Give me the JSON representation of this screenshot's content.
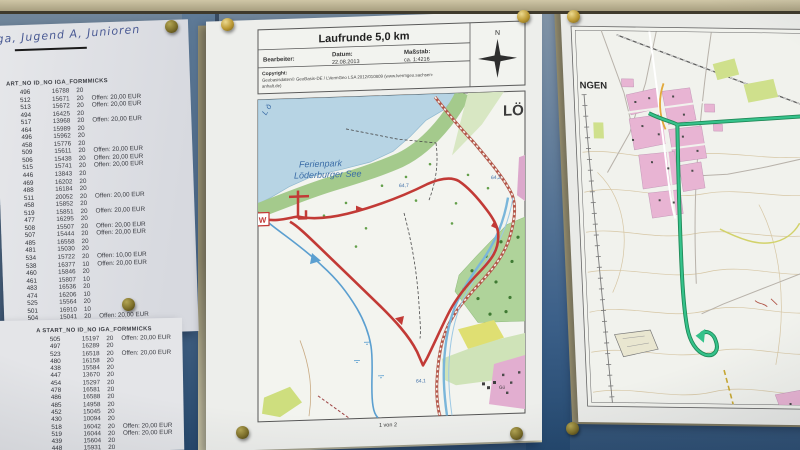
{
  "handwriting": {
    "text": "ga, Jugend A, Junioren"
  },
  "left_tables": {
    "top": {
      "header": "ART_NO  ID_NO  IGA_FORMMICKS",
      "rows": [
        [
          "496",
          "16788",
          "20",
          ""
        ],
        [
          "512",
          "15671",
          "20",
          "Offen: 20,00 EUR"
        ],
        [
          "513",
          "15672",
          "20",
          "Offen: 20,00 EUR"
        ],
        [
          "494",
          "16425",
          "20",
          ""
        ],
        [
          "517",
          "13968",
          "20",
          "Offen: 20,00 EUR"
        ],
        [
          "464",
          "15989",
          "20",
          ""
        ],
        [
          "496",
          "15962",
          "20",
          ""
        ],
        [
          "458",
          "15776",
          "20",
          ""
        ],
        [
          "509",
          "15611",
          "20",
          "Offen: 20,00 EUR"
        ],
        [
          "506",
          "15438",
          "20",
          "Offen: 20,00 EUR"
        ],
        [
          "515",
          "15741",
          "20",
          "Offen: 20,00 EUR"
        ],
        [
          "446",
          "13843",
          "20",
          ""
        ],
        [
          "469",
          "16202",
          "20",
          ""
        ],
        [
          "488",
          "16184",
          "20",
          ""
        ],
        [
          "511",
          "20052",
          "20",
          "Offen: 20,00 EUR"
        ],
        [
          "458",
          "15852",
          "20",
          ""
        ],
        [
          "519",
          "15851",
          "20",
          "Offen: 20,00 EUR"
        ],
        [
          "477",
          "16295",
          "20",
          ""
        ],
        [
          "508",
          "15507",
          "20",
          "Offen: 20,00 EUR"
        ],
        [
          "507",
          "15444",
          "20",
          "Offen: 20,00 EUR"
        ],
        [
          "485",
          "16558",
          "20",
          ""
        ],
        [
          "481",
          "15030",
          "20",
          ""
        ],
        [
          "534",
          "15722",
          "20",
          "Offen: 10,00 EUR"
        ],
        [
          "538",
          "16377",
          "10",
          "Offen: 20,00 EUR"
        ],
        [
          "460",
          "15846",
          "20",
          ""
        ],
        [
          "461",
          "15807",
          "10",
          ""
        ],
        [
          "483",
          "16536",
          "20",
          ""
        ],
        [
          "474",
          "16206",
          "10",
          ""
        ],
        [
          "525",
          "15564",
          "20",
          ""
        ],
        [
          "501",
          "16910",
          "10",
          ""
        ],
        [
          "504",
          "15041",
          "20",
          "Offen: 20,00 EUR"
        ],
        [
          "463",
          "15769",
          "20",
          ""
        ]
      ]
    },
    "bottom": {
      "header": "A  START_NO  ID_NO  IGA_FORMMICKS",
      "rows": [
        [
          "505",
          "15197",
          "20",
          "Offen: 20,00 EUR"
        ],
        [
          "497",
          "16289",
          "20",
          ""
        ],
        [
          "523",
          "16518",
          "20",
          "Offen: 20,00 EUR"
        ],
        [
          "480",
          "16158",
          "20",
          ""
        ],
        [
          "438",
          "15584",
          "20",
          ""
        ],
        [
          "447",
          "13670",
          "20",
          ""
        ],
        [
          "454",
          "15297",
          "20",
          ""
        ],
        [
          "478",
          "16581",
          "20",
          ""
        ],
        [
          "486",
          "16588",
          "20",
          ""
        ],
        [
          "485",
          "14958",
          "20",
          ""
        ],
        [
          "452",
          "15045",
          "20",
          ""
        ],
        [
          "430",
          "10094",
          "20",
          ""
        ],
        [
          "518",
          "16042",
          "20",
          "Offen: 20,00 EUR"
        ],
        [
          "519",
          "16044",
          "20",
          "Offen: 20,00 EUR"
        ],
        [
          "439",
          "15604",
          "20",
          ""
        ],
        [
          "448",
          "15931",
          "20",
          ""
        ]
      ]
    }
  },
  "map_sheet": {
    "title": "Laufrunde 5,0 km",
    "bearbeiter_label": "Bearbeiter:",
    "datum_label": "Datum:",
    "datum_value": "22.08.2013",
    "massstab_label": "Maßstab:",
    "massstab_value": "ca. 1:4216",
    "copyright_label": "Copyright:",
    "copyright_line1": "Geobasisdaten© GeoBasis-DE / LVermGeo LSA 2012/010809 (www.lvermgeo.sachsen-",
    "copyright_line2": "anhalt.de)",
    "compass_n": "N",
    "labels": {
      "town": "LÖ",
      "park_line1": "Ferienpark",
      "park_line2": "Löderburger See",
      "lake_script": "L ö",
      "start": "W",
      "elev1": "64,7",
      "elev2": "64,2",
      "elev3": "64,1",
      "buildings": "Gü"
    },
    "footer": "1 von 2"
  },
  "right_sheet": {
    "town_label": "NGEN"
  },
  "colors": {
    "board_blue": "#5b7894",
    "board_navy": "#27496d",
    "rail_tan": "#b5ac8e",
    "route_red": "#c23a36",
    "railway_red": "#b4574a",
    "lake_blue": "#b7d4e4",
    "shore_green": "#a4ca8c",
    "track_green": "#35c28b",
    "pin_gold": "#bb9832",
    "ink_blue": "#4a5a94",
    "label_blue": "#3a6ca6",
    "village_pink": "#e8b4d3"
  }
}
